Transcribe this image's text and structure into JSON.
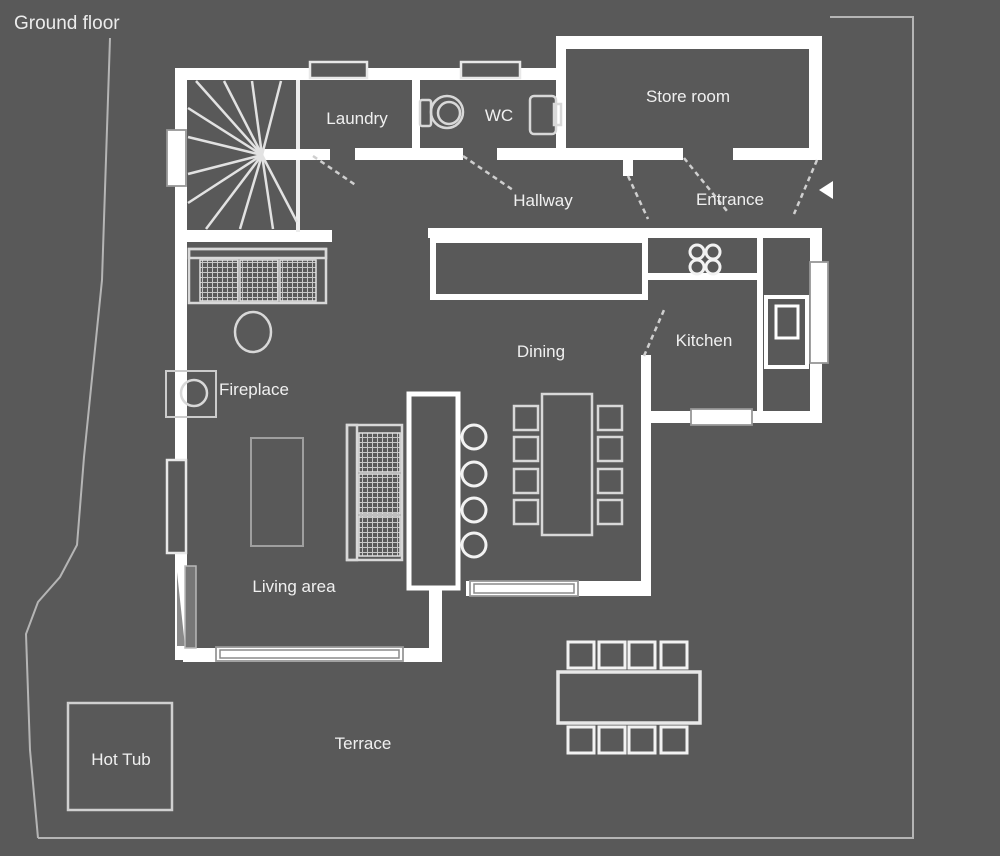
{
  "title": "Ground floor",
  "labels": {
    "laundry": "Laundry",
    "wc": "WC",
    "store_room": "Store room",
    "hallway": "Hallway",
    "entrance": "Entrance",
    "kitchen": "Kitchen",
    "dining": "Dining",
    "fireplace": "Fireplace",
    "living_area": "Living area",
    "hot_tub": "Hot Tub",
    "terrace": "Terrace"
  },
  "colors": {
    "background": "#595959",
    "wall": "#ffffff",
    "furniture_outline": "#d8d8d8",
    "boundary_line": "#b5b5b5",
    "text": "#f0f0f0"
  }
}
